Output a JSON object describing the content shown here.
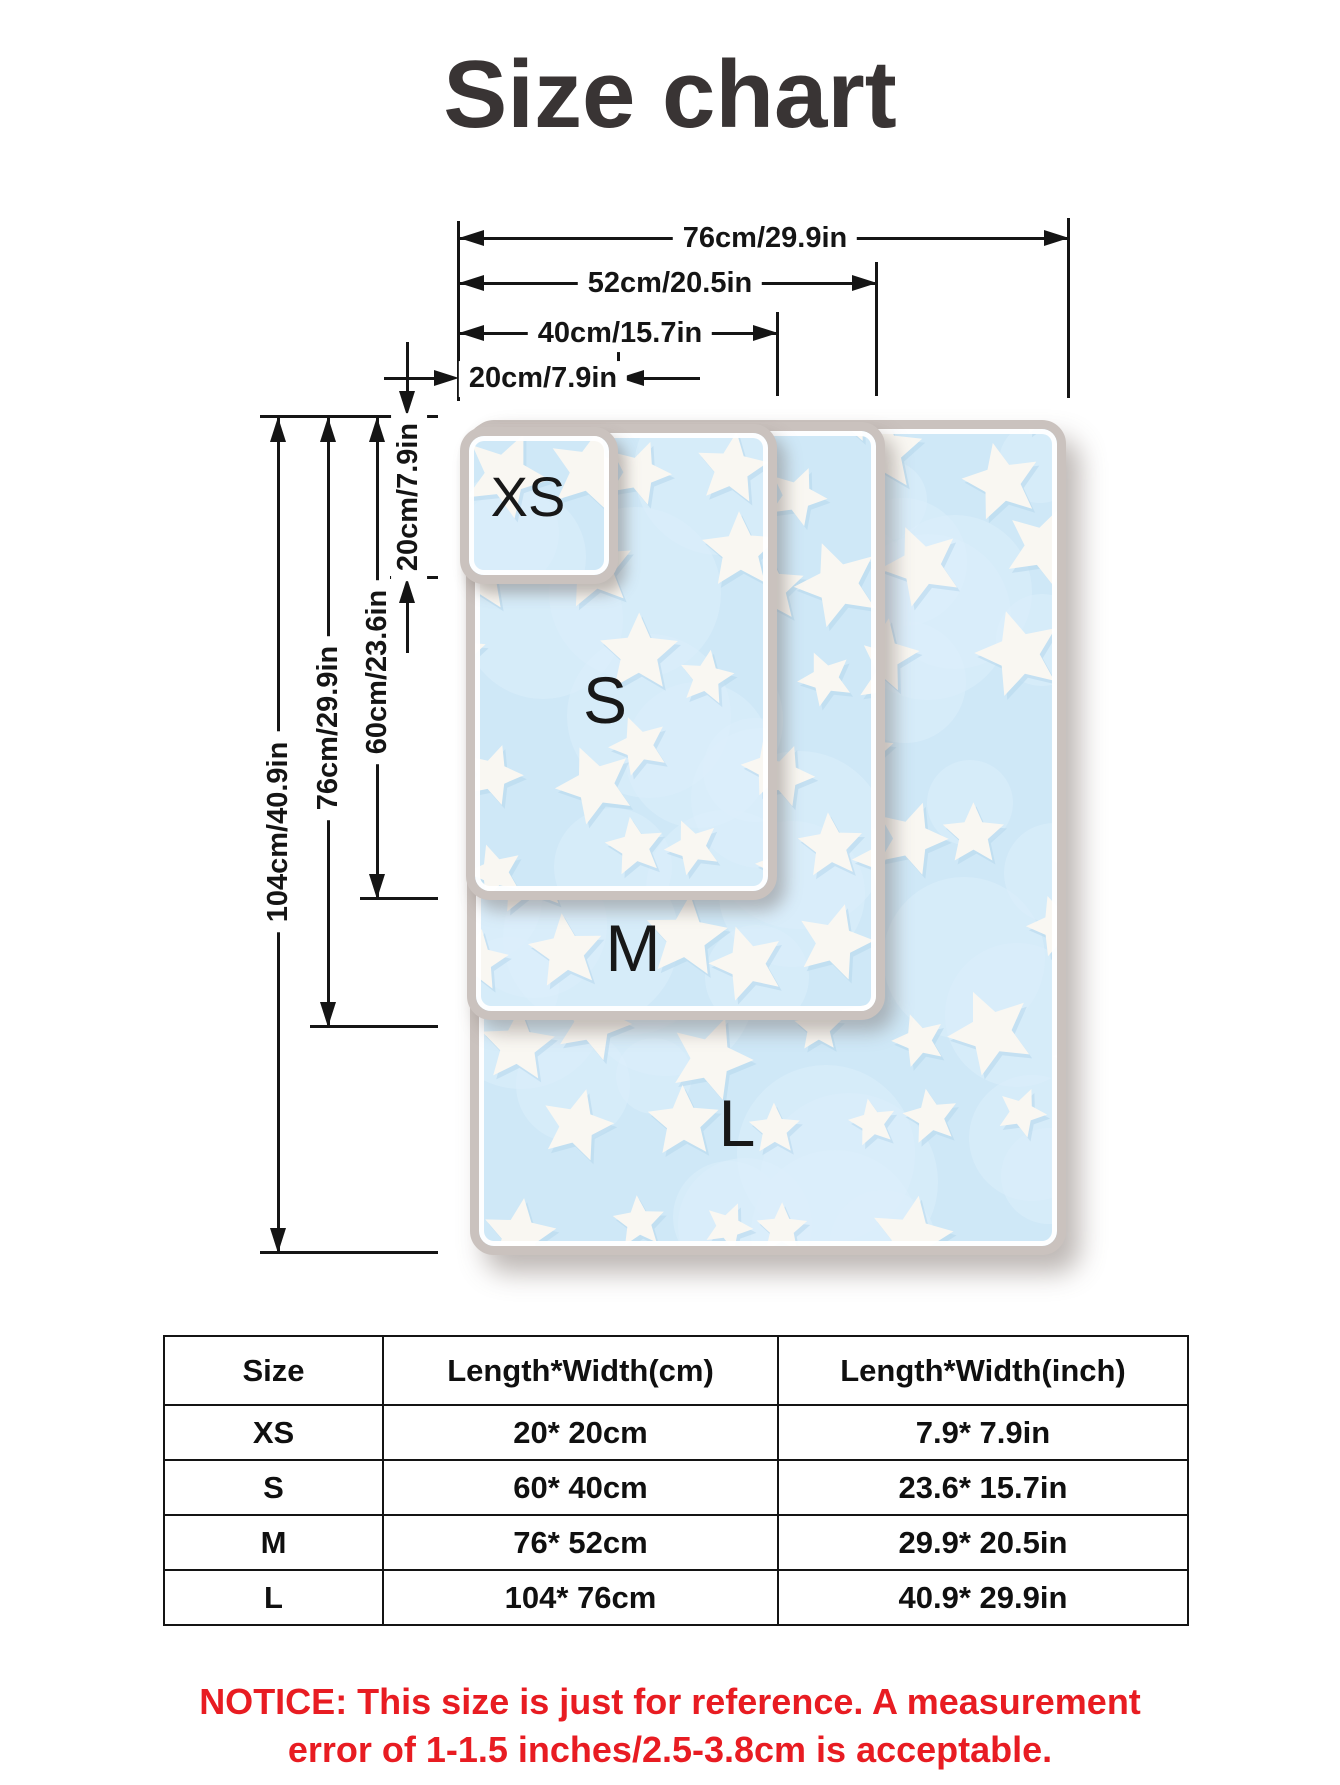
{
  "title": "Size chart",
  "diagram": {
    "width_dims": [
      {
        "label": "76cm/29.9in"
      },
      {
        "label": "52cm/20.5in"
      },
      {
        "label": "40cm/15.7in"
      },
      {
        "label": "20cm/7.9in"
      }
    ],
    "height_dims": [
      {
        "label": "104cm/40.9in"
      },
      {
        "label": "76cm/29.9in"
      },
      {
        "label": "60cm/23.6in"
      },
      {
        "label": "20cm/7.9in"
      }
    ],
    "blankets": [
      {
        "label": "XS"
      },
      {
        "label": "S"
      },
      {
        "label": "M"
      },
      {
        "label": "L"
      }
    ]
  },
  "table": {
    "columns": [
      "Size",
      "Length*Width(cm)",
      "Length*Width(inch)"
    ],
    "rows": [
      [
        "XS",
        "20* 20cm",
        "7.9* 7.9in"
      ],
      [
        "S",
        "60* 40cm",
        "23.6* 15.7in"
      ],
      [
        "M",
        "76* 52cm",
        "29.9* 20.5in"
      ],
      [
        "L",
        "104* 76cm",
        "40.9* 29.9in"
      ]
    ]
  },
  "notice": {
    "line1": "NOTICE: This size is just for reference. A measurement",
    "line2": "error of 1-1.5 inches/2.5-3.8cm is acceptable."
  },
  "colors": {
    "title": "#393434",
    "dimension_lines": "#151515",
    "blanket_fill": "#cfe8f7",
    "blanket_border": "#cac2be",
    "star": "#f9f7f2",
    "notice_red": "#e81c22"
  }
}
